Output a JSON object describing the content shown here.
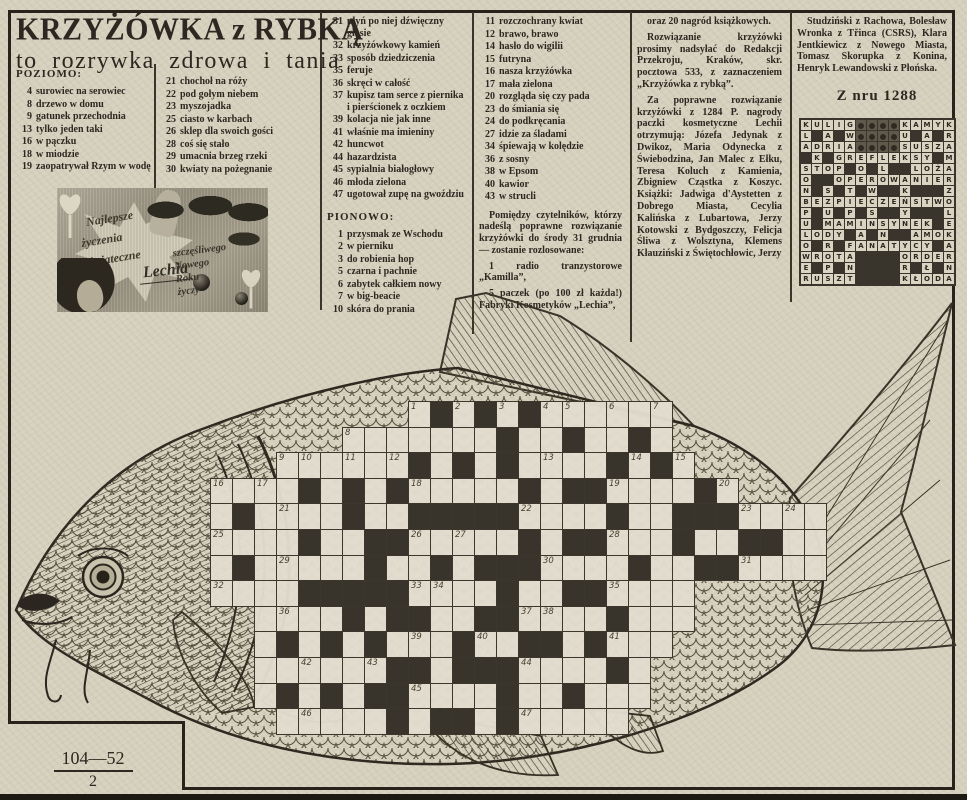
{
  "colors": {
    "paper": "#d8d3c0",
    "ink": "#2c2821",
    "grid_black": "#39342b"
  },
  "title": {
    "main": "KRZYŻÓWKA z RYBKĄ",
    "sub": "to rozrywka zdrowa i tania"
  },
  "headers": {
    "across": "POZIOMO:",
    "down": "PIONOWO:",
    "from_issue": "Z nru 1288"
  },
  "clues": {
    "across_col1": [
      {
        "n": "4",
        "t": "surowiec na serowiec"
      },
      {
        "n": "8",
        "t": "drzewo w domu"
      },
      {
        "n": "9",
        "t": "gatunek przechodnia"
      },
      {
        "n": "13",
        "t": "tylko jeden taki"
      },
      {
        "n": "16",
        "t": "w pączku"
      },
      {
        "n": "18",
        "t": "w miodzie"
      },
      {
        "n": "19",
        "t": "zaopatrywał Rzym w wodę"
      }
    ],
    "across_col2": [
      {
        "n": "21",
        "t": "chochoł na róży"
      },
      {
        "n": "22",
        "t": "pod gołym niebem"
      },
      {
        "n": "23",
        "t": "myszojadka"
      },
      {
        "n": "25",
        "t": "ciasto w karbach"
      },
      {
        "n": "26",
        "t": "sklep dla swoich gości"
      },
      {
        "n": "28",
        "t": "coś się stało"
      },
      {
        "n": "29",
        "t": "umacnia brzeg rzeki"
      },
      {
        "n": "30",
        "t": "kwiaty na pożegnanie"
      }
    ],
    "across_col3": [
      {
        "n": "31",
        "t": "płyń po niej dźwięczny głosie"
      },
      {
        "n": "32",
        "t": "krzyżówkowy kamień"
      },
      {
        "n": "33",
        "t": "sposób dziedziczenia"
      },
      {
        "n": "35",
        "t": "feruje"
      },
      {
        "n": "36",
        "t": "skręci w całość"
      },
      {
        "n": "37",
        "t": "kupisz tam serce z piernika i pierścionek z oczkiem"
      },
      {
        "n": "39",
        "t": "kolacja nie jak inne"
      },
      {
        "n": "41",
        "t": "właśnie ma imieniny"
      },
      {
        "n": "42",
        "t": "huncwot"
      },
      {
        "n": "44",
        "t": "hazardzista"
      },
      {
        "n": "45",
        "t": "sypialnia białogłowy"
      },
      {
        "n": "46",
        "t": "młoda zielona"
      },
      {
        "n": "47",
        "t": "ugotował zupę na gwoździu"
      }
    ],
    "down_col1": [
      {
        "n": "1",
        "t": "przysmak ze Wschodu"
      },
      {
        "n": "2",
        "t": "w pierniku"
      },
      {
        "n": "3",
        "t": "do robienia hop"
      },
      {
        "n": "5",
        "t": "czarna i pachnie"
      },
      {
        "n": "6",
        "t": "zabytek całkiem nowy"
      },
      {
        "n": "7",
        "t": "w big-beacie"
      },
      {
        "n": "10",
        "t": "skóra do prania"
      }
    ],
    "down_col2": [
      {
        "n": "11",
        "t": "rozczochrany kwiat"
      },
      {
        "n": "12",
        "t": "brawo, brawo"
      },
      {
        "n": "14",
        "t": "hasło do wigilii"
      },
      {
        "n": "15",
        "t": "futryna"
      },
      {
        "n": "16",
        "t": "nasza krzyżówka"
      },
      {
        "n": "17",
        "t": "mała zielona"
      },
      {
        "n": "20",
        "t": "rozgląda się czy pada"
      },
      {
        "n": "23",
        "t": "do śmiania się"
      },
      {
        "n": "24",
        "t": "do podkręcania"
      },
      {
        "n": "27",
        "t": "idzie za śladami"
      },
      {
        "n": "34",
        "t": "śpiewają w kolędzie"
      },
      {
        "n": "36",
        "t": "z sosny"
      },
      {
        "n": "38",
        "t": "w Epsom"
      },
      {
        "n": "40",
        "t": "kawior"
      },
      {
        "n": "43",
        "t": "w strucli"
      }
    ]
  },
  "contest": {
    "col4_paras": [
      "Pomiędzy czytelników, którzy nadeślą poprawne rozwiązanie krzyżówki do środy 31 grudnia — zostanie rozlosowane:",
      "1 radio tranzystorowe „Kamilla”,",
      "5 paczek (po 100 zł każda!) Fabryki Kosmetyków „Lechia”,"
    ],
    "col5_paras": [
      "oraz 20 nagród książkowych.",
      "Rozwiązanie krzyżówki prosimy nadsyłać do Redakcji Przekroju, Kraków, skr. pocztowa 533, z zaznaczeniem „Krzyżówka z rybką”.",
      "Za poprawne rozwiązanie krzyżówki z 1284 P. nagrody paczki kosmetyczne Lechii otrzymują: Józefa Jedynak z Dwikoz, Maria Odynecka z Świebodzina, Jan Malec z Ełku, Teresa Koluch z Kamienia, Zbigniew Cząstka z Koszyc. Książki: Jadwiga d'Aystetten z Dobrego Miasta, Cecylia Kalińska z Lubartowa, Jerzy Kotowski z Bydgoszczy, Felicja Śliwa z Wolsztyna, Klemens Kłauziński z Świętochłowic, Jerzy"
    ],
    "col6_paras": [
      "Studziński z Rachowa, Bolesław Wronka z Třinca (CSRS), Klara Jentkiewicz z Nowego Miasta, Tomasz Skorupka z Konina, Henryk Lewandowski z Płońska."
    ]
  },
  "photo": {
    "lines1": [
      "Najlepsze",
      "życzenia",
      "świąteczne"
    ],
    "lines2": [
      "szczęśliwego",
      "Nowego",
      "Roku",
      "życzy"
    ],
    "signature": "Lechia"
  },
  "solved_grid": {
    "note": "solution of crossword from issue 1288; . = black cell, # = photo cell",
    "rows": [
      "KULIG####KAMYK",
      "L.A.W####U.A.R",
      "ADRIA####SUSZA",
      ".K.GREFLEKSY.M",
      "STOP.O.L..LOŻA",
      "O..OPEROWANIER",
      "N.S.T.W..K...Z",
      "BEZPIECZEŃSTWO",
      "P.U.P.S..Y...L",
      "U.MAMINSYNEK.E",
      "LODY.A.N..AMOK",
      "O.R.FANATYCY.A",
      "WROTA....ORDER",
      "E.P.N....R.Ł.N",
      "RUSZT....KŁODA"
    ]
  },
  "fish_grid": {
    "note": "empty crossword inside fish drawing; space = no cell, # = black cell, . = white cell",
    "rows": [
      "         .#.#.#......       ",
      "      .......#..#..#.       ",
      "   ......#.#.#....#.#.      ",
      "....#.#.#.....#.##....#.    ",
      ".#....#..#####....#..###....",
      "....#..##.....#.##...#..##..",
      ".#.....#..#.###....#..##....",
      "....#####....#..##....      ",
      "  ....#.##..##....#...      ",
      "  .#.#.#...#..##.#...       ",
      "  ......##.###....#.        ",
      "  .#.#.##....#..#...        ",
      "   .....#.##.#.....         "
    ],
    "numbers": {
      "1": [
        0,
        9
      ],
      "2": [
        0,
        11
      ],
      "3": [
        0,
        13
      ],
      "4": [
        0,
        15
      ],
      "5": [
        0,
        16
      ],
      "6": [
        0,
        18
      ],
      "7": [
        0,
        20
      ],
      "8": [
        1,
        6
      ],
      "9": [
        2,
        3
      ],
      "10": [
        2,
        4
      ],
      "11": [
        2,
        6
      ],
      "12": [
        2,
        8
      ],
      "13": [
        2,
        15
      ],
      "14": [
        2,
        19
      ],
      "15": [
        2,
        21
      ],
      "16": [
        3,
        0
      ],
      "17": [
        3,
        2
      ],
      "18": [
        3,
        9
      ],
      "19": [
        3,
        18
      ],
      "20": [
        3,
        23
      ],
      "21": [
        4,
        3
      ],
      "22": [
        4,
        14
      ],
      "23": [
        4,
        24
      ],
      "24": [
        4,
        26
      ],
      "25": [
        5,
        0
      ],
      "26": [
        5,
        9
      ],
      "27": [
        5,
        11
      ],
      "28": [
        5,
        18
      ],
      "29": [
        6,
        3
      ],
      "30": [
        6,
        15
      ],
      "31": [
        6,
        24
      ],
      "32": [
        7,
        0
      ],
      "33": [
        7,
        9
      ],
      "34": [
        7,
        10
      ],
      "35": [
        7,
        18
      ],
      "36": [
        8,
        3
      ],
      "37": [
        8,
        14
      ],
      "38": [
        8,
        15
      ],
      "39": [
        9,
        9
      ],
      "40": [
        9,
        12
      ],
      "41": [
        9,
        18
      ],
      "42": [
        10,
        4
      ],
      "43": [
        10,
        7
      ],
      "44": [
        10,
        14
      ],
      "45": [
        11,
        9
      ],
      "46": [
        12,
        4
      ],
      "47": [
        12,
        14
      ]
    }
  },
  "footer": {
    "page_code": "104—52",
    "page_sub": "2"
  }
}
